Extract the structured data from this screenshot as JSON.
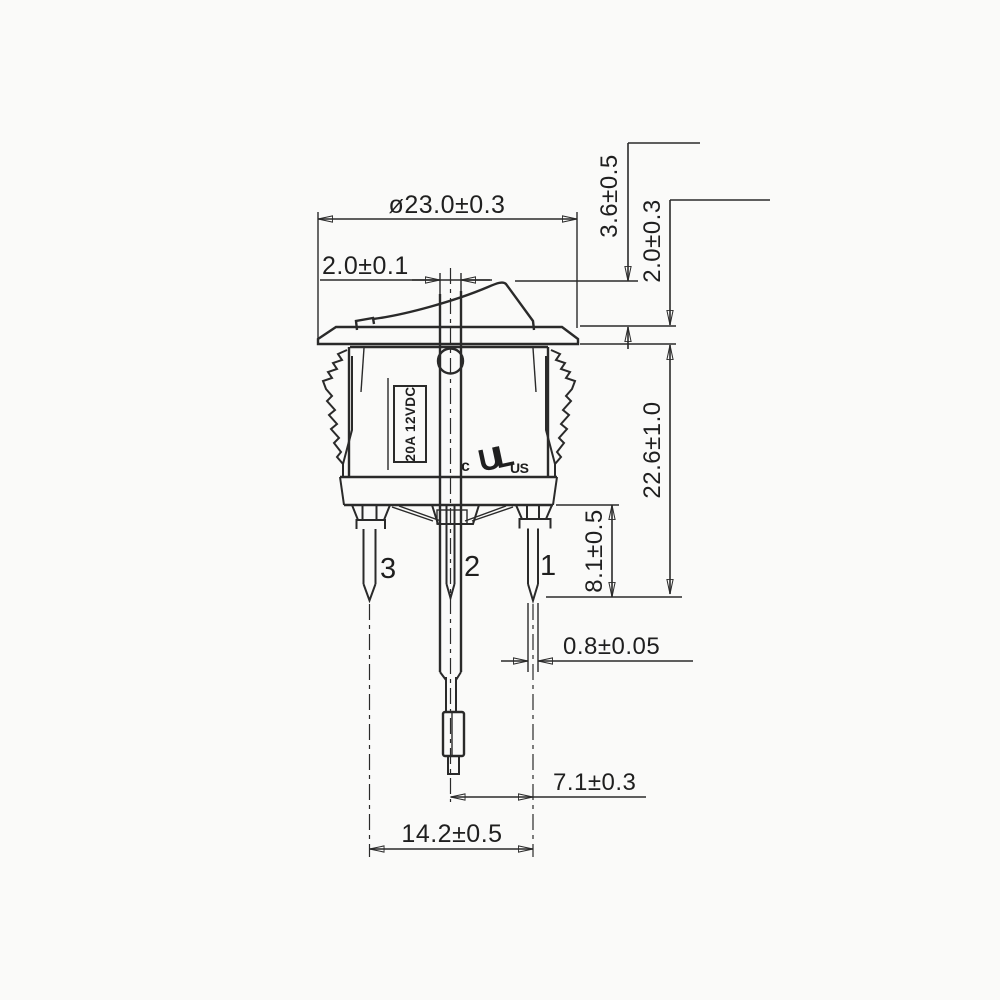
{
  "dims": {
    "diameter": "ø23.0±0.3",
    "stem_width": "2.0±0.1",
    "rocker_height": "3.6±0.5",
    "flange_thickness": "2.0±0.3",
    "body_depth": "22.6±1.0",
    "terminal_length": "8.1±0.5",
    "terminal_thickness": "0.8±0.05",
    "pitch_center": "7.1±0.3",
    "pitch_outer": "14.2±0.5"
  },
  "markings": {
    "rating": "20A 12VDC",
    "ul_prefix": "c",
    "ul_logo": "UL",
    "ul_suffix": "US"
  },
  "terminals": {
    "left": "3",
    "center": "2",
    "right": "1"
  },
  "colors": {
    "line": "#2a2a2a",
    "text": "#1f1f1f",
    "background": "#fafaf9"
  }
}
